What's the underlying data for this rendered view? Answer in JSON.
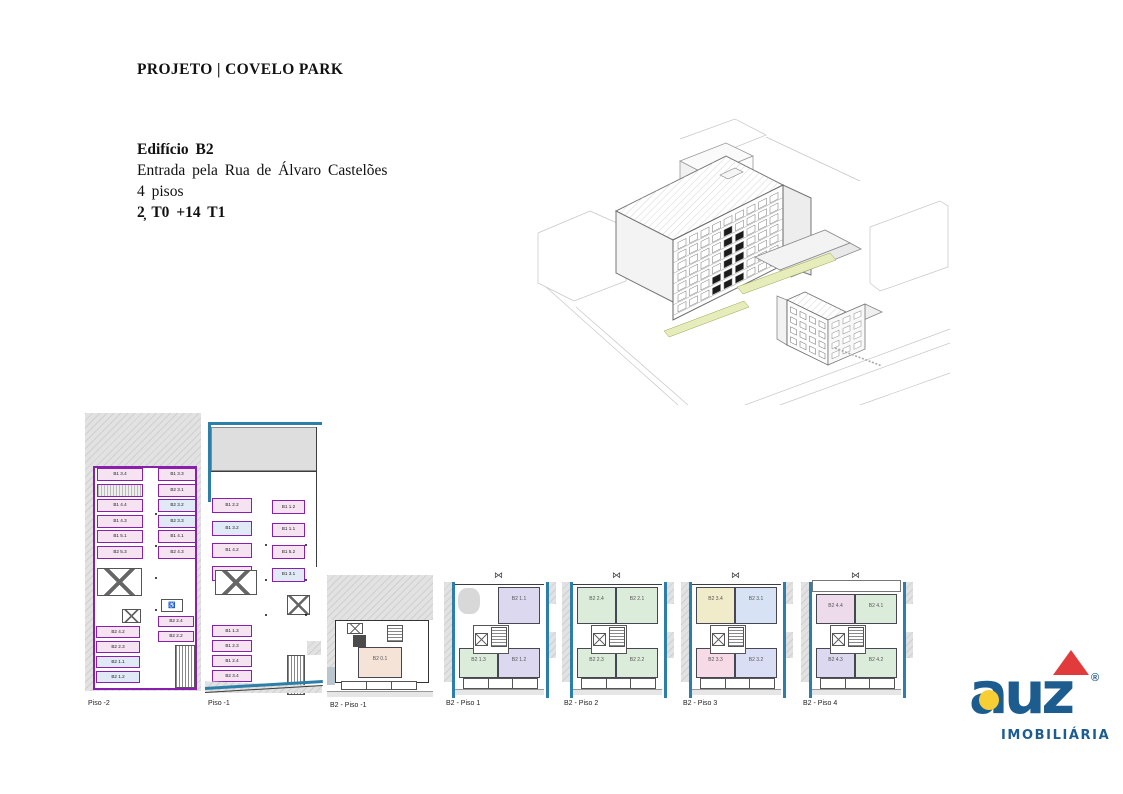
{
  "header": {
    "title": "PROJETO | COVELO PARK"
  },
  "building_info": {
    "name": "Edifício B2",
    "entrance": "Entrada pela Rua de Álvaro Castelões",
    "floors": "4 pisos",
    "units": "2̦ T0 +14 T1"
  },
  "icons": {
    "accessible_parking": "♿",
    "skylight_bowtie": "⋈"
  },
  "plans": [
    {
      "caption": "Piso -2",
      "type": "garage",
      "stalls": {
        "upper_left": [
          {
            "label": "B1 3.4",
            "fill": "pink"
          },
          {
            "label": "",
            "fill": "hatch"
          },
          {
            "label": "B1 4.4",
            "fill": "pink"
          },
          {
            "label": "B1 4.3",
            "fill": "pink"
          },
          {
            "label": "B1 5.1",
            "fill": "pink"
          },
          {
            "label": "B2 5.3",
            "fill": "pink"
          }
        ],
        "upper_right": [
          {
            "label": "B1 3.3",
            "fill": "pink"
          },
          {
            "label": "B2 3.1",
            "fill": "pink"
          },
          {
            "label": "B2 3.2",
            "fill": "blue"
          },
          {
            "label": "B2 3.3",
            "fill": "blue"
          },
          {
            "label": "B1 4.1",
            "fill": "pink"
          },
          {
            "label": "B2 4.3",
            "fill": "pink"
          }
        ],
        "lower_left": [
          {
            "label": "B2 4.2",
            "fill": "pink"
          },
          {
            "label": "B2 2.3",
            "fill": "pink"
          },
          {
            "label": "B2 1.1",
            "fill": "blue"
          },
          {
            "label": "B2 1.2",
            "fill": "blue"
          }
        ],
        "lower_right": [
          {
            "label": "B2 2.4",
            "fill": "pink"
          },
          {
            "label": "B2 2.2",
            "fill": "pink"
          }
        ]
      }
    },
    {
      "caption": "Piso -1",
      "type": "garage",
      "stalls": {
        "upper_left": [
          {
            "label": "B1 2.2",
            "fill": "pink"
          },
          {
            "label": "B1 3.2",
            "fill": "blue"
          },
          {
            "label": "B1 4.2",
            "fill": "pink"
          },
          {
            "label": "B1 2.1",
            "fill": "pink"
          }
        ],
        "upper_right": [
          {
            "label": "B1 1.2",
            "fill": "pink"
          },
          {
            "label": "B1 1.1",
            "fill": "pink"
          },
          {
            "label": "B1 5.2",
            "fill": "pink"
          },
          {
            "label": "B1 3.1",
            "fill": "blue"
          }
        ],
        "lower_left": [
          {
            "label": "B1 1.3",
            "fill": "pink"
          },
          {
            "label": "B1 2.3",
            "fill": "pink"
          },
          {
            "label": "B1 2.4",
            "fill": "pink"
          },
          {
            "label": "B2 3.4",
            "fill": "pink"
          }
        ],
        "lower_right": []
      }
    },
    {
      "caption": "B2 - Piso -1",
      "type": "basement",
      "rooms": [
        {
          "label": "B2 0.1",
          "fill": "peach",
          "pos": "c"
        }
      ]
    },
    {
      "caption": "B2 - Piso 1",
      "type": "apartment",
      "rooms": [
        {
          "label": "B2 1.1",
          "fill": "lavender",
          "pos": "tr"
        },
        {
          "label": "B2 1.3",
          "fill": "green",
          "pos": "bl"
        },
        {
          "label": "B2 1.2",
          "fill": "lavender",
          "pos": "br"
        }
      ]
    },
    {
      "caption": "B2 - Piso 2",
      "type": "apartment",
      "rooms": [
        {
          "label": "B2 2.4",
          "fill": "green",
          "pos": "tl"
        },
        {
          "label": "B2 2.1",
          "fill": "green",
          "pos": "tr"
        },
        {
          "label": "B2 2.3",
          "fill": "green",
          "pos": "bl"
        },
        {
          "label": "B2 2.2",
          "fill": "green",
          "pos": "br"
        }
      ]
    },
    {
      "caption": "B2 - Piso 3",
      "type": "apartment",
      "rooms": [
        {
          "label": "B2 3.4",
          "fill": "yellow",
          "pos": "tl"
        },
        {
          "label": "B2 3.1",
          "fill": "ltblue",
          "pos": "tr"
        },
        {
          "label": "B2 3.3",
          "fill": "pinkapt",
          "pos": "bl"
        },
        {
          "label": "B2 3.2",
          "fill": "periwinkle",
          "pos": "br"
        }
      ]
    },
    {
      "caption": "B2 - Piso 4",
      "type": "apartment",
      "rooms": [
        {
          "label": "B2 4.4",
          "fill": "mauve",
          "pos": "tl"
        },
        {
          "label": "B2 4.1",
          "fill": "green",
          "pos": "tr"
        },
        {
          "label": "B2 4.3",
          "fill": "lavender",
          "pos": "bl"
        },
        {
          "label": "B2 4.2",
          "fill": "green",
          "pos": "br"
        }
      ]
    }
  ],
  "palette": {
    "purple": "#8a1fae",
    "blue_wall": "#2b7fa9",
    "pink": "#f6e3f2",
    "blue": "#dfeaf6",
    "hatch": "#ededed",
    "green": "#dcecdb",
    "lavender": "#dbd8ef",
    "yellow": "#f0ecc9",
    "ltblue": "#d7e3f4",
    "pinkapt": "#f6dbe7",
    "periwinkle": "#d9def4",
    "mauve": "#eddaeb",
    "peach": "#f6e3d8",
    "logo_blue": "#1d5c8e",
    "logo_yellow": "#f7ce33",
    "logo_red": "#e23b3b"
  },
  "logo": {
    "brand": "auz",
    "registered": "®",
    "tagline": "IMOBILIÁRIA"
  }
}
